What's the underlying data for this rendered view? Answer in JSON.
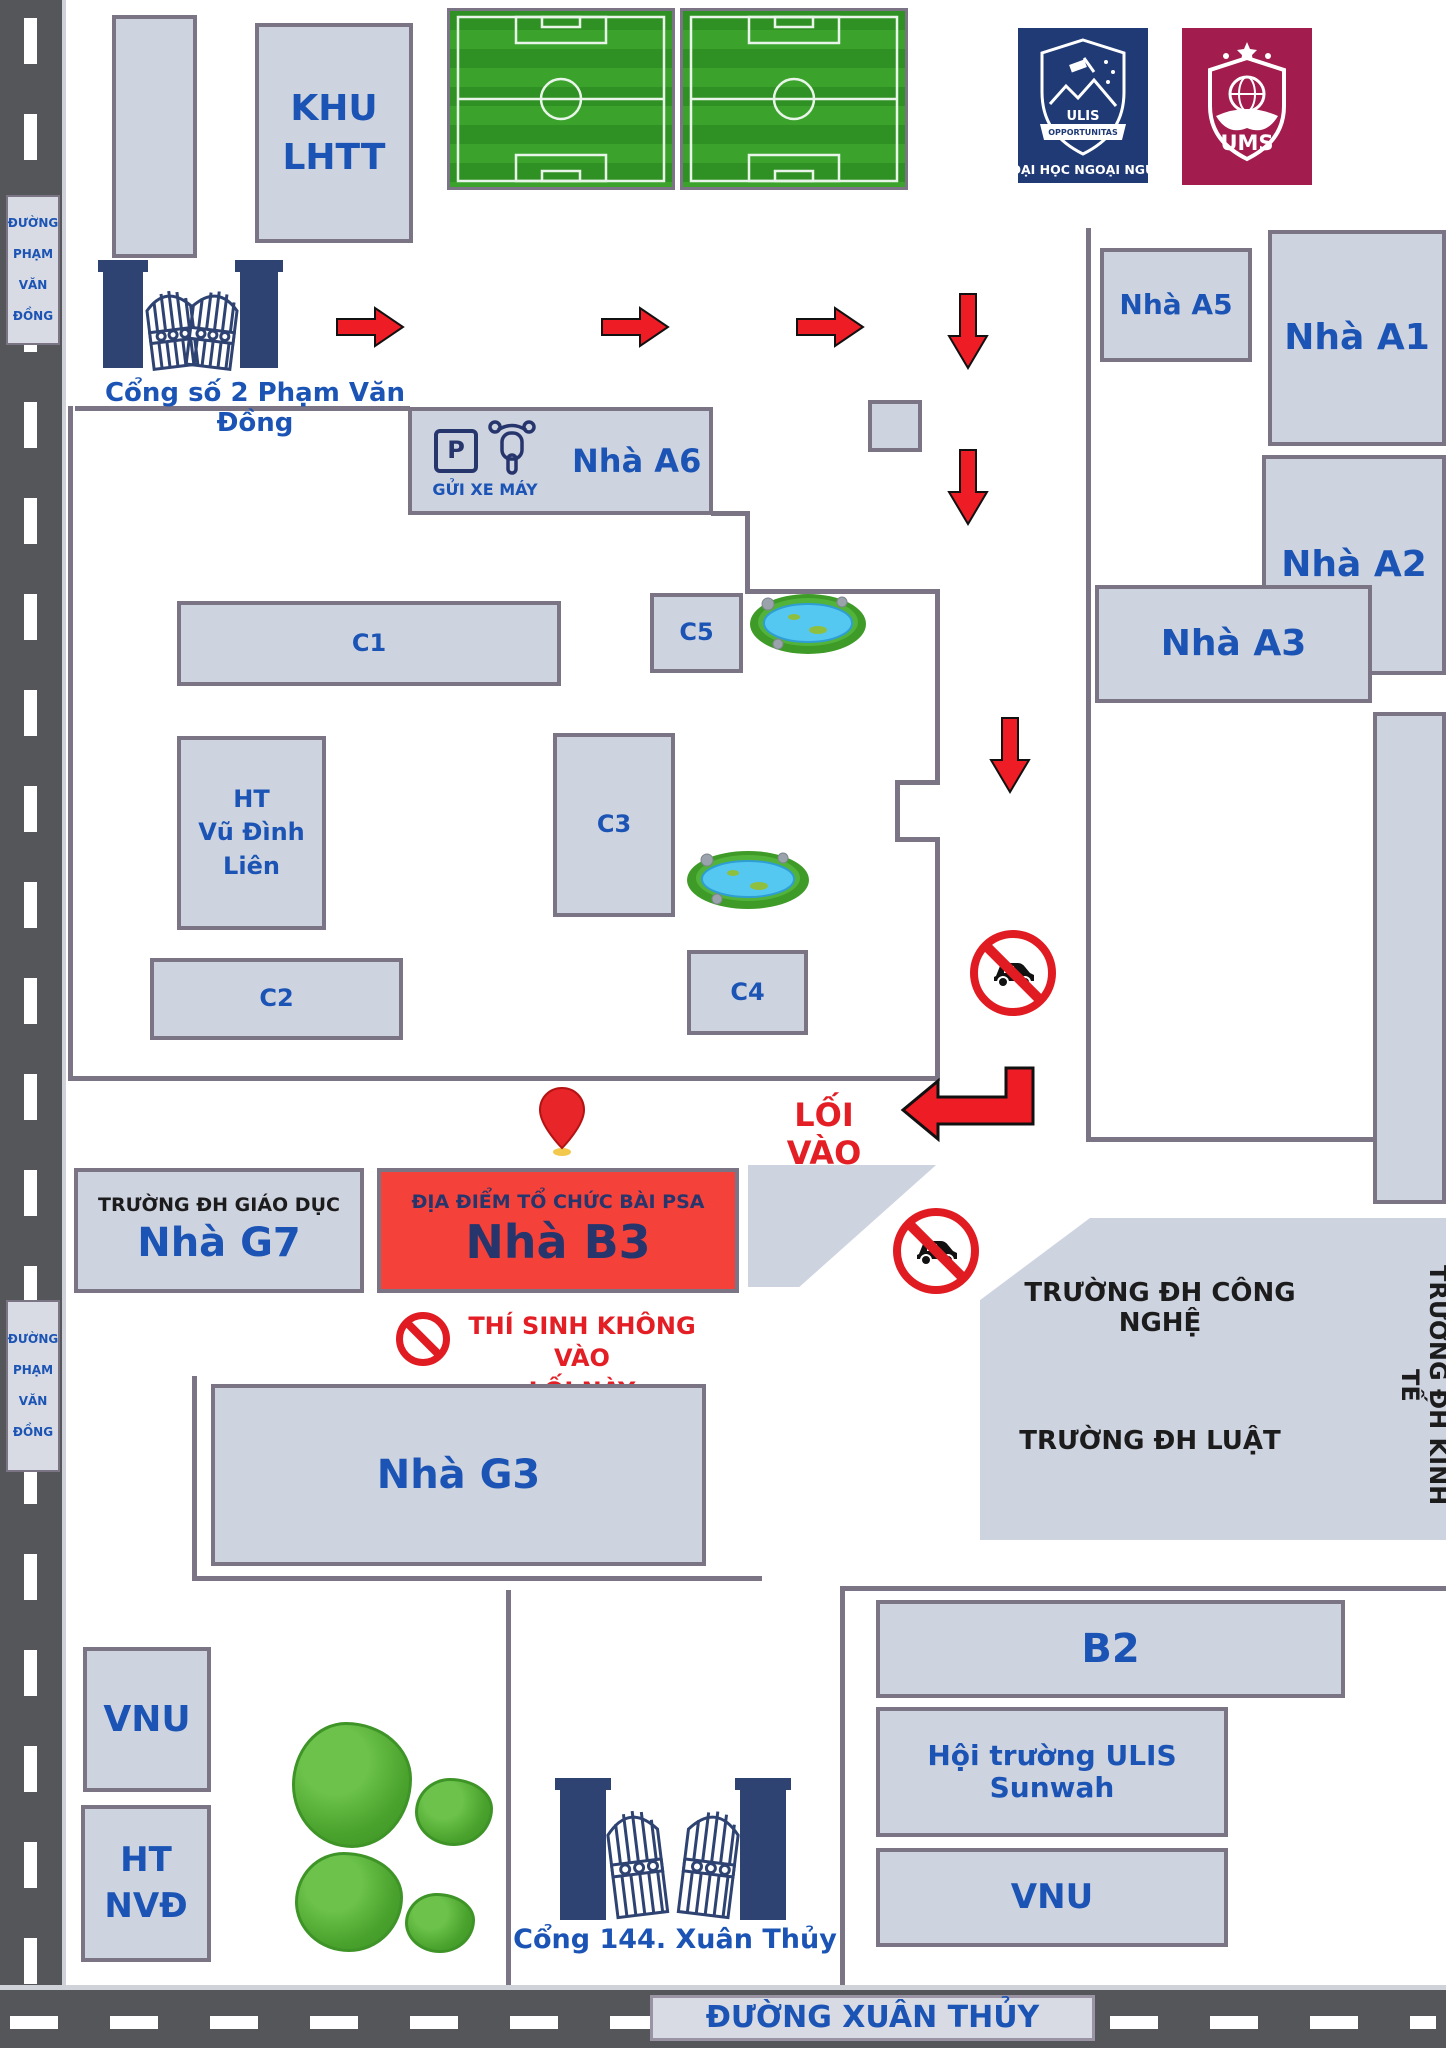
{
  "roads": {
    "pham_van_dong": {
      "lines": [
        "ĐƯỜNG",
        "PHẠM",
        "VĂN",
        "ĐỒNG"
      ]
    },
    "xuan_thuy_label": "ĐƯỜNG XUÂN THỦY"
  },
  "gates": {
    "gate2_label": "Cổng số 2 Phạm Văn Đồng",
    "gate144_label": "Cổng 144. Xuân Thủy"
  },
  "logos": {
    "ulis": {
      "abbr": "ULIS",
      "motto": "OPPORTUNITAS",
      "caption": "ĐẠI HỌC NGOẠI NGỮ"
    },
    "ums": {
      "abbr": "UMS"
    }
  },
  "buildings": {
    "khu_lhtt": {
      "line1": "KHU",
      "line2": "LHTT"
    },
    "a5": "Nhà A5",
    "a1": "Nhà A1",
    "a2": "Nhà A2",
    "a3": "Nhà A3",
    "a6": "Nhà A6",
    "c1": "C1",
    "c2": "C2",
    "c3": "C3",
    "c4": "C4",
    "c5": "C5",
    "ht_vdl": {
      "line1": "HT",
      "line2": "Vũ Đình",
      "line3": "Liên"
    },
    "g7": {
      "line1": "TRƯỜNG ĐH GIÁO DỤC",
      "line2": "Nhà G7"
    },
    "b3": {
      "line1": "ĐỊA ĐIỂM TỔ CHỨC BÀI PSA",
      "line2": "Nhà B3"
    },
    "g3": "Nhà G3",
    "cong_nghe": "TRƯỜNG ĐH CÔNG NGHỆ",
    "luat": "TRƯỜNG ĐH LUẬT",
    "kinh_te": "TRƯỜNG ĐH KINH TẾ",
    "vnu_left": "VNU",
    "ht_nvd": {
      "line1": "HT",
      "line2": "NVĐ"
    },
    "b2": "B2",
    "sunwah": "Hội trường ULIS Sunwah",
    "vnu_right": "VNU"
  },
  "signs": {
    "gui_xe_may": "GỬI XE MÁY",
    "parking_letter": "P",
    "loi_vao": "LỐI VÀO",
    "thi_sinh_line1": "THÍ SINH KHÔNG VÀO",
    "thi_sinh_line2": "LỐI NÀY"
  },
  "colors": {
    "building_fill": "#ced3e0",
    "wall": "#7b7484",
    "road": "#55565a",
    "blue_text": "#1b54b4",
    "navy_text": "#27356d",
    "red_accent": "#e31e24",
    "b3_fill": "#f4423a",
    "ulis_blue": "#1f3a75",
    "ums_maroon": "#a21c4d",
    "field_green": "#2f9023"
  }
}
